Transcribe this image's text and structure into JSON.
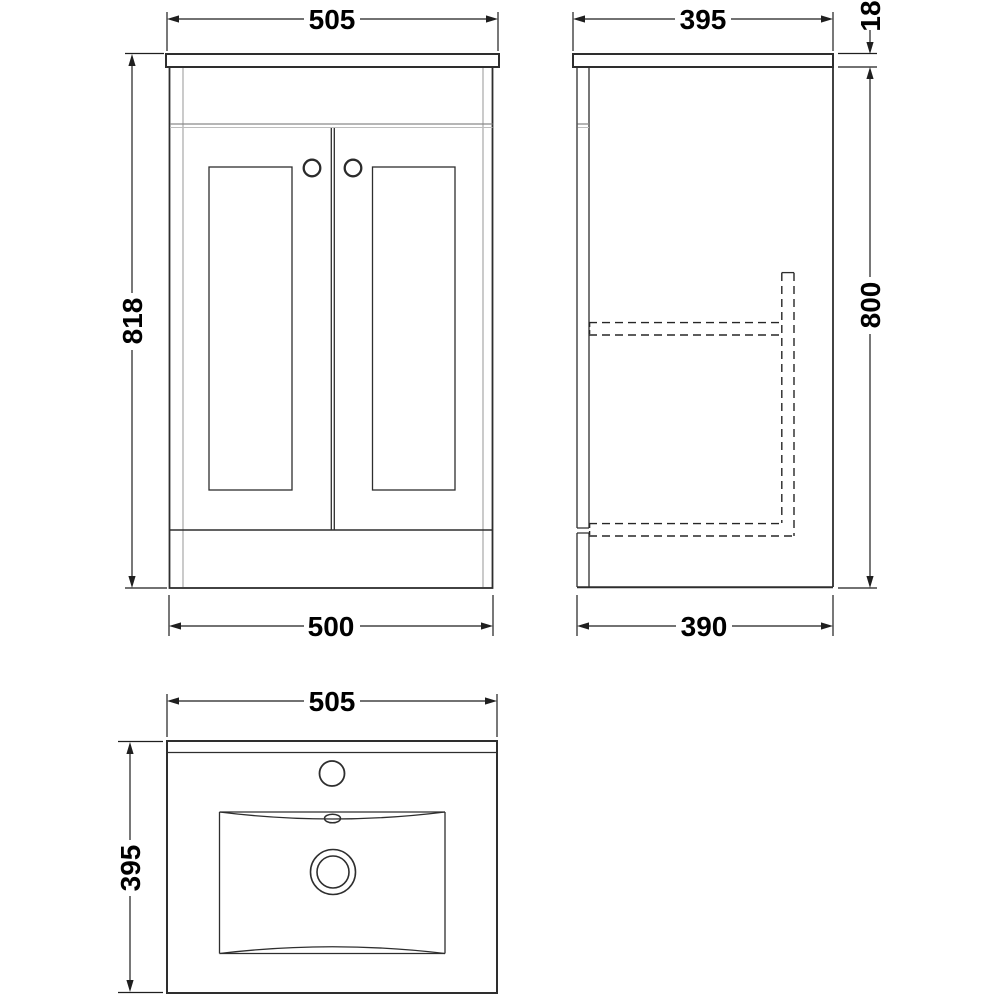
{
  "drawing": {
    "front_view": {
      "width_top": "505",
      "height": "818",
      "width_bottom": "500"
    },
    "side_view": {
      "depth_top": "395",
      "worktop_thickness": "18",
      "body_height": "800",
      "depth_bottom": "390"
    },
    "plan_view": {
      "width": "505",
      "depth": "395"
    }
  },
  "colors": {
    "background": "#ffffff",
    "line": "#2e2e2e",
    "light_line": "#a8a8a8",
    "hidden_line": "#262626",
    "text": "#000000"
  }
}
